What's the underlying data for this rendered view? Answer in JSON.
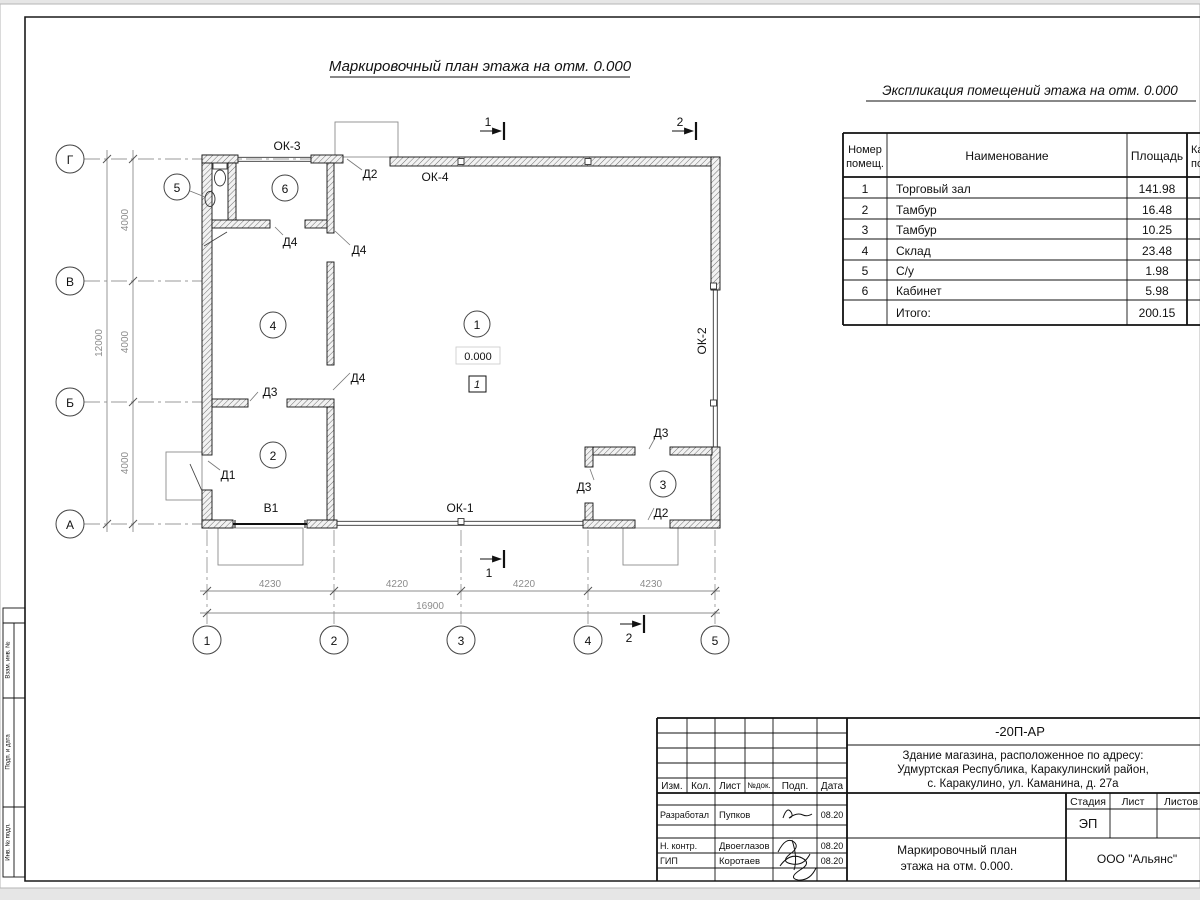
{
  "titles": {
    "plan": "Маркировочный план этажа на отм. 0.000",
    "explication": "Экспликация помещений этажа на отм. 0.000"
  },
  "plan": {
    "axis_rows": [
      "Г",
      "В",
      "Б",
      "А"
    ],
    "axis_cols": [
      "1",
      "2",
      "3",
      "4",
      "5"
    ],
    "dims": {
      "left": [
        "4000",
        "4000",
        "4000"
      ],
      "left_total": "12000",
      "bottom": [
        "4230",
        "4220",
        "4220",
        "4230"
      ],
      "bottom_total": "16900"
    },
    "rooms": [
      "1",
      "2",
      "3",
      "4",
      "5",
      "6"
    ],
    "marks": {
      "elevation": "0.000",
      "floor": "1"
    },
    "windows": {
      "ok1": "ОК-1",
      "ok2": "ОК-2",
      "ok3": "ОК-3",
      "ok4": "ОК-4"
    },
    "doors": {
      "d1": "Д1",
      "d2": "Д2",
      "d3": "Д3",
      "d4": "Д4",
      "gate": "В1"
    },
    "sections": {
      "s1": "1",
      "s2": "2"
    }
  },
  "explication": {
    "header": {
      "num1": "Номер",
      "num2": "помещ.",
      "name": "Наименование",
      "area": "Площадь",
      "cat1": "Ка",
      "cat2": "по"
    },
    "rows": [
      {
        "num": "1",
        "name": "Торговый зал",
        "area": "141.98"
      },
      {
        "num": "2",
        "name": "Тамбур",
        "area": "16.48"
      },
      {
        "num": "3",
        "name": "Тамбур",
        "area": "10.25"
      },
      {
        "num": "4",
        "name": "Склад",
        "area": "23.48"
      },
      {
        "num": "5",
        "name": "С/у",
        "area": "1.98"
      },
      {
        "num": "6",
        "name": "Кабинет",
        "area": "5.98"
      }
    ],
    "total": {
      "label": "Итого:",
      "area": "200.15"
    }
  },
  "title_block": {
    "doc_number": "-20П-АР",
    "object_line1": "Здание магазина, расположенное по адресу:",
    "object_line2": "Удмуртская Республика, Каракулинский район,",
    "object_line3": "с. Каракулино, ул. Каманина, д. 27а",
    "head": {
      "izm": "Изм.",
      "kol": "Кол.",
      "list": "Лист",
      "ndok": "№док.",
      "podp": "Подп.",
      "data": "Дата"
    },
    "roles": [
      {
        "role": "Разработал",
        "name": "Пупков",
        "date": "08.20"
      },
      {
        "role": "Н. контр.",
        "name": "Двоеглазов",
        "date": "08.20"
      },
      {
        "role": "ГИП",
        "name": "Коротаев",
        "date": "08.20"
      }
    ],
    "stage_label": "Стадия",
    "sheet_label": "Лист",
    "sheets_label": "Листов",
    "stage_value": "ЭП",
    "drawing_name1": "Маркировочный план",
    "drawing_name2": "этажа на отм. 0.000.",
    "org": "ООО \"Альянс\""
  },
  "side_stamp": {
    "cell1": "Взам. инв. №",
    "cell2": "Подп. и дата",
    "cell3": "Инв. № подл."
  }
}
